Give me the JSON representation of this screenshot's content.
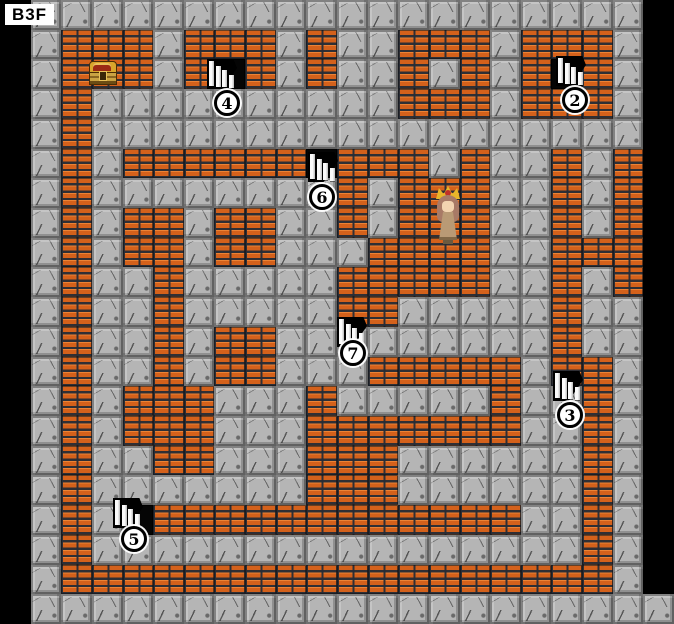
{
  "floor_label": "B3F",
  "map": {
    "cols": 22,
    "rows": 21,
    "grid_legend": {
      ".": "void",
      "G": "floor",
      "B": "brick-wall",
      "S": "stairs-tile"
    },
    "grid": [
      ".GGGGGGGGGGGGGGGGGGGG.",
      ".GBBBGBBBGBGGBBBGBBBG.",
      ".GBBBGBSBGBGGBGBGBSBG.",
      ".GBGGGGGGGGGGBBBGBBBG.",
      ".GBGGGGGGGGGGGGGGGGGG.",
      ".GBGBBBBBBSBBBGBGGBGB.",
      ".GBGGGGGGGGBGBBBGGBGB.",
      ".GBGBBGBBGGBGBBBGGBGB.",
      ".GBGBBGBBGGGBBBBGGBBB.",
      ".GBGGBGGGGGBBBBBGGBGB.",
      ".GBGGBGGGGGBBGGGGGBGG.",
      ".GBGGBGBBGGGGGGGGGBGG.",
      ".GBGGBGBBGGGBBBBBGBBG.",
      ".GBGBBBGGGBGGGGGBGGBG.",
      ".GBGBBBGGGBBBBBBBGGBG.",
      ".GBGGBBGGGBBBGGGGGGBG.",
      ".GBGGGGGGGBBBGGGGGGBG.",
      ".GBGSBBBBBBBBBBBBGGBG.",
      ".GBGGGGGGGGGGGGGGGGBG.",
      ".GBBBBBBBBBBBBBBBBBBG.",
      ".GGGGGGGGGGGGGGGGGGGGG"
    ]
  },
  "colors": {
    "void": "#000000",
    "floor": "#b5b5b5",
    "floor_crack": "#2d2d2d",
    "brick": "#d4611b",
    "brick_highlight": "#ff9e4a",
    "mortar": "#262c36",
    "marker_fill": "#ffffff",
    "marker_border": "#000000",
    "label_bg": "#ffffff",
    "label_text": "#000000"
  },
  "markers": [
    {
      "number": "4",
      "x": 214,
      "y": 90
    },
    {
      "number": "2",
      "x": 562,
      "y": 87
    },
    {
      "number": "6",
      "x": 309,
      "y": 184
    },
    {
      "number": "7",
      "x": 340,
      "y": 340
    },
    {
      "number": "3",
      "x": 557,
      "y": 402
    },
    {
      "number": "5",
      "x": 121,
      "y": 526
    }
  ],
  "stairs": [
    {
      "id": "stairs-4",
      "x": 207,
      "y": 59
    },
    {
      "id": "stairs-2",
      "x": 556,
      "y": 56
    },
    {
      "id": "stairs-6",
      "x": 308,
      "y": 152
    },
    {
      "id": "stairs-7",
      "x": 337,
      "y": 317
    },
    {
      "id": "stairs-3",
      "x": 553,
      "y": 371
    },
    {
      "id": "stairs-5",
      "x": 113,
      "y": 498
    }
  ],
  "treasure_chest": {
    "x": 89,
    "y": 61
  },
  "character": {
    "x": 434,
    "y": 186
  }
}
